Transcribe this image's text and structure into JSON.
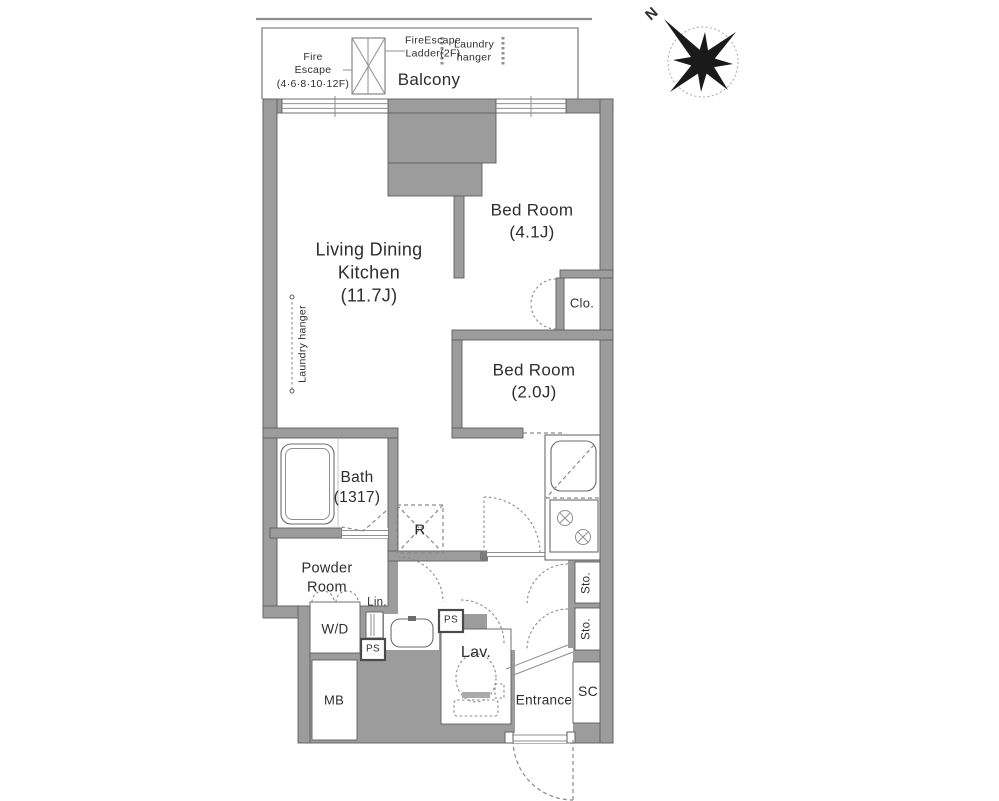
{
  "compass": {
    "north": "N"
  },
  "balcony": {
    "label": "Balcony",
    "laundry_hanger": "Laundry\nhanger",
    "fire_escape": "Fire\nEscape\n(4·6·8·10·12F)",
    "fire_escape_ladder": "FireEscape\nLadder(2F)"
  },
  "rooms": {
    "ldk": "Living Dining\nKitchen\n(11.7J)",
    "bedroom1": "Bed Room\n(4.1J)",
    "bedroom2": "Bed Room\n(2.0J)",
    "bath": "Bath\n(1317)",
    "powder_room": "Powder\nRoom",
    "lavatory": "Lav.",
    "entrance": "Entrance"
  },
  "storage": {
    "closet": "Clo.",
    "shoe_closet": "SC",
    "storage_upper": "Sto.",
    "storage_lower": "Sto.",
    "linen": "Lin."
  },
  "fixtures": {
    "refrigerator": "R",
    "washer_dryer": "W/D",
    "meter_box": "MB",
    "pipe_space_1": "PS",
    "pipe_space_2": "PS",
    "laundry_hanger_indoor": "Laundry hanger"
  },
  "colors": {
    "wall_fill": "#9c9c9c",
    "outline": "#5f5f5f",
    "text": "#2e2e2e",
    "dashed": "#8a8a8a",
    "background": "#ffffff"
  }
}
